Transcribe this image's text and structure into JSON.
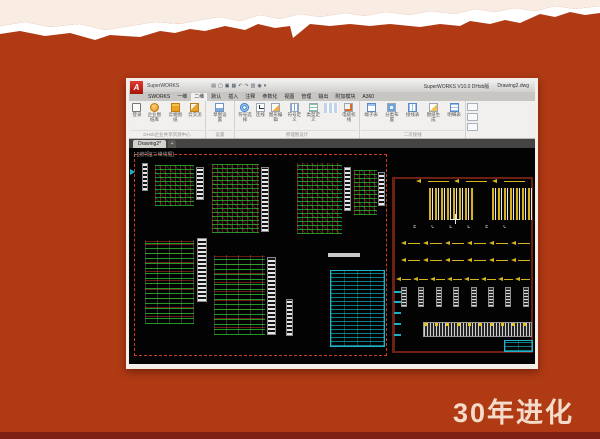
{
  "slide": {
    "caption": "30年进化",
    "colors": {
      "background": "#b03a14",
      "cream_top": "#f9ece2",
      "torn_white": "#ffffff",
      "bottom_strip": "#7e2112",
      "caption_text": "#f5dcca"
    }
  },
  "window": {
    "titlebar": {
      "logo_letter": "A",
      "app_title": "SuperWORKS",
      "right_app": "SuperWORKS V10.0 DHsb版",
      "right_doc": "Drawing2.dwg"
    },
    "quick_access": [
      {
        "name": "app-menu",
        "glyph": "▤"
      },
      {
        "name": "new-file",
        "glyph": "▢"
      },
      {
        "name": "open-file",
        "glyph": "▣"
      },
      {
        "name": "save-file",
        "glyph": "▦"
      },
      {
        "name": "undo",
        "glyph": "↶"
      },
      {
        "name": "redo",
        "glyph": "↷"
      },
      {
        "name": "print",
        "glyph": "▥"
      },
      {
        "name": "settings",
        "glyph": "◉"
      },
      {
        "name": "more",
        "glyph": "▾"
      }
    ],
    "ribbon_tabs": [
      {
        "label": "SWORKS",
        "active": false
      },
      {
        "label": "一维",
        "active": false
      },
      {
        "label": "二维",
        "active": true
      },
      {
        "label": "默认",
        "active": false
      },
      {
        "label": "插入",
        "active": false
      },
      {
        "label": "注释",
        "active": false
      },
      {
        "label": "参数化",
        "active": false
      },
      {
        "label": "视图",
        "active": false
      },
      {
        "label": "管理",
        "active": false
      },
      {
        "label": "输出",
        "active": false
      },
      {
        "label": "附加模块",
        "active": false
      },
      {
        "label": "A360",
        "active": false
      }
    ],
    "ribbon_groups": [
      {
        "label": "DHsb企业共享资源中心",
        "buttons": [
          {
            "label": "登录",
            "icon": "login"
          },
          {
            "label": "企业图纸库",
            "icon": "disc"
          },
          {
            "label": "云端图纸",
            "icon": "folder"
          },
          {
            "label": "云交流",
            "icon": "tool"
          }
        ]
      },
      {
        "label": "设置",
        "buttons": [
          {
            "label": "草图设置",
            "icon": "sketch"
          }
        ]
      },
      {
        "label": "原理图设计",
        "buttons": [
          {
            "label": "符号选择",
            "icon": "symbol"
          },
          {
            "label": "连线",
            "icon": "wire"
          },
          {
            "label": "图形编辑",
            "icon": "edit"
          },
          {
            "label": "符号定义",
            "icon": "define"
          },
          {
            "label": "类型定义",
            "icon": "type"
          },
          {
            "label": "",
            "icon": "minigrid"
          },
          {
            "label": "电缆校线",
            "icon": "cable"
          }
        ]
      },
      {
        "label": "二次接线",
        "buttons": [
          {
            "label": "端子表",
            "icon": "ttable"
          },
          {
            "label": "分类布置",
            "icon": "layout"
          },
          {
            "label": "接线表",
            "icon": "wtable"
          },
          {
            "label": "图纸生成",
            "icon": "gen"
          },
          {
            "label": "明细表",
            "icon": "bom"
          }
        ]
      }
    ],
    "doc_tabs": [
      {
        "label": "Drawing2",
        "modified": "*"
      }
    ],
    "new_tab_label": "+"
  },
  "canvas": {
    "viewport_label": "[-][俯视][二维线框]",
    "symbol_row_text": "E C L L E C",
    "elements": [
      {
        "type": "frame-red",
        "x": 1.2,
        "y": 3,
        "w": 62.3,
        "h": 93.5
      },
      {
        "type": "frame-maroon",
        "x": 64.8,
        "y": 13.5,
        "w": 34.7,
        "h": 81.5
      },
      {
        "type": "terminal",
        "x": 3.2,
        "y": 7,
        "w": 1.6,
        "h": 13
      },
      {
        "type": "schematic",
        "x": 6.5,
        "y": 8,
        "w": 9.5,
        "h": 19
      },
      {
        "type": "terminal",
        "x": 16.6,
        "y": 9,
        "w": 1.8,
        "h": 15
      },
      {
        "type": "schematic",
        "x": 20.5,
        "y": 7.5,
        "w": 11.5,
        "h": 32
      },
      {
        "type": "terminal",
        "x": 32.6,
        "y": 9,
        "w": 2,
        "h": 30
      },
      {
        "type": "schematic",
        "x": 41.5,
        "y": 7,
        "w": 11,
        "h": 33
      },
      {
        "type": "terminal",
        "x": 53,
        "y": 9,
        "w": 1.8,
        "h": 20
      },
      {
        "type": "schematic",
        "x": 55.5,
        "y": 10,
        "w": 5.5,
        "h": 21
      },
      {
        "type": "terminal",
        "x": 61.4,
        "y": 11,
        "w": 1.6,
        "h": 16
      },
      {
        "type": "schematic-lines",
        "x": 4,
        "y": 42.5,
        "w": 12,
        "h": 39
      },
      {
        "type": "terminal",
        "x": 16.8,
        "y": 41.5,
        "w": 2.4,
        "h": 30
      },
      {
        "type": "schematic-lines",
        "x": 21,
        "y": 49.5,
        "w": 12.5,
        "h": 37
      },
      {
        "type": "terminal",
        "x": 34,
        "y": 50.5,
        "w": 2.2,
        "h": 36
      },
      {
        "type": "terminal",
        "x": 38.6,
        "y": 70,
        "w": 1.8,
        "h": 17
      },
      {
        "type": "wlabel",
        "x": 49,
        "y": 48.5,
        "w": 8,
        "h": 1.8
      },
      {
        "type": "cyan-table",
        "x": 49.5,
        "y": 56.5,
        "w": 13.6,
        "h": 35.5
      },
      {
        "type": "ybars",
        "x": 74,
        "y": 18.5,
        "w": 11,
        "h": 15
      },
      {
        "type": "ybars",
        "x": 89.3,
        "y": 18.5,
        "w": 10,
        "h": 15
      },
      {
        "type": "arrow-row",
        "count": 3,
        "x": 70,
        "y": 14,
        "w": 28,
        "h": 3
      },
      {
        "type": "symbol-row",
        "x": 70,
        "y": 35.5,
        "w": 29,
        "h": 4
      },
      {
        "type": "arrow-row",
        "count": 6,
        "x": 66.5,
        "y": 42,
        "w": 32.5,
        "h": 4
      },
      {
        "type": "arrow-row",
        "count": 6,
        "x": 66.5,
        "y": 50,
        "w": 32.5,
        "h": 4
      },
      {
        "type": "arrow-row",
        "count": 8,
        "x": 65.5,
        "y": 58.5,
        "w": 33.5,
        "h": 4
      },
      {
        "type": "post-row",
        "count": 8,
        "x": 67,
        "y": 64.5,
        "w": 31.5,
        "h": 9
      },
      {
        "type": "striped-table",
        "x": 72.3,
        "y": 80.5,
        "w": 27,
        "h": 7
      },
      {
        "type": "cyan-table",
        "x": 92.3,
        "y": 89,
        "w": 7.2,
        "h": 5.5
      },
      {
        "type": "cyan-tags",
        "count": 5,
        "x": 65.3,
        "y": 66,
        "w": 1.6,
        "h": 21
      },
      {
        "type": "crosshair",
        "x": 79,
        "y": 30.5,
        "w": 2.5,
        "h": 4.5
      },
      {
        "type": "cyan-marker",
        "x": 0.3,
        "y": 9.5,
        "w": 1.4,
        "h": 3
      }
    ]
  }
}
